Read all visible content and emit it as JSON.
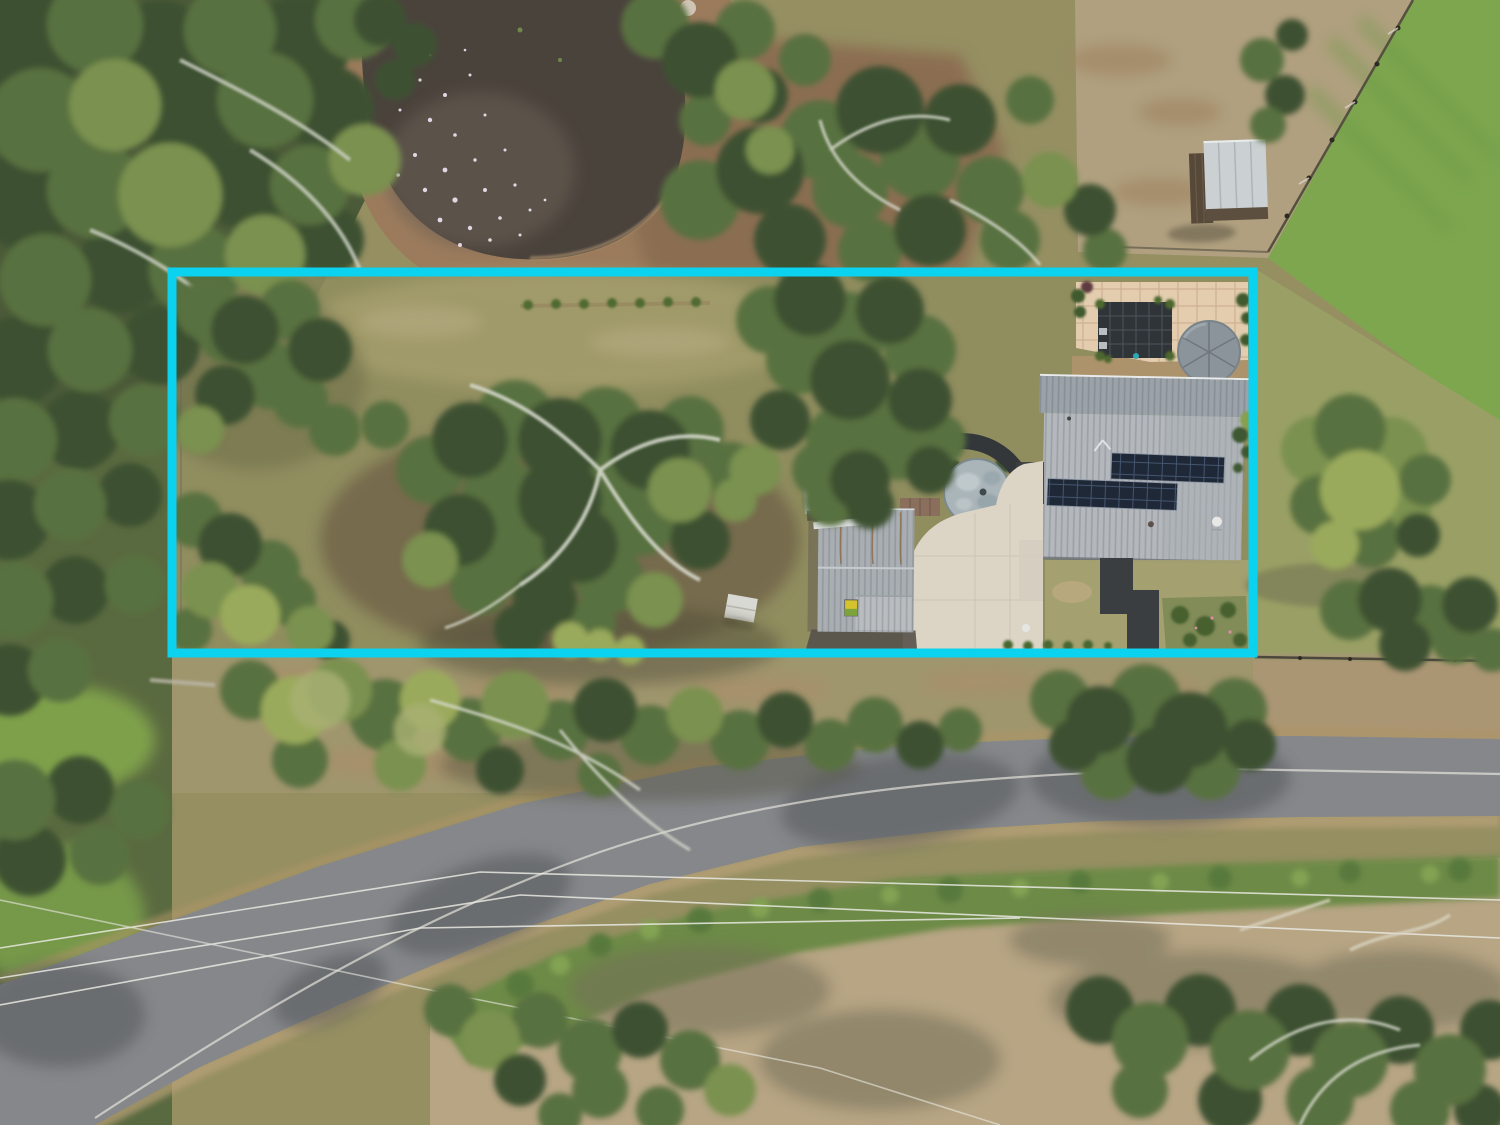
{
  "scene": {
    "kind": "aerial-drone-photograph",
    "description": "Top-down drone photo of a semi-rural residential acreage lot outlined with a cyan property-boundary overlay. Inside the boundary: treed paddock on the left, house with grey corrugated roof and two rows of solar panels on the right, paved patio with dark pergola and round water tank, older round tank, detached garage with wheelie bin, large concrete driveway, lawn with dark paved paths and garden beds. Outside: dam/pond at top, small shed and bright green fenced paddock top right, bitumen road with white centre line curving across the bottom, power lines, dry grass verges and dense gum trees.",
    "overlay": {
      "label": "property-boundary-highlight",
      "shape": "rectangle",
      "x": 172,
      "y": 272,
      "width": 1081,
      "height": 381,
      "stroke_px": 9
    },
    "features": [
      "dam-pond-with-sun-sparkle",
      "dirt-bank",
      "gum-tree-forest-top-left",
      "small-shed-top-right",
      "diagonal-paddock-fence",
      "bright-green-paddock",
      "house-grey-corrugated-roof",
      "solar-panel-array-row-1",
      "solar-panel-array-row-2",
      "veranda-roof",
      "paved-patio",
      "dark-pergola-spa-cover",
      "round-water-tank-new",
      "round-water-tank-old",
      "detached-garage",
      "yellow-lid-wheelie-bin",
      "concrete-driveway",
      "charcoal-garden-paths",
      "garden-beds",
      "shrub-row",
      "small-cabin-in-trees",
      "white-marquee",
      "bitumen-road",
      "road-centre-line",
      "power-lines",
      "grass-verges",
      "tree-shadows"
    ],
    "colors": {
      "boundary_cyan": "#0BD2EF",
      "pond_water": "#4A433C",
      "grass_olive": "#958F62",
      "grass_dry": "#B7A584",
      "paddock_green": "#7DA64F",
      "road_asphalt": "#85878A",
      "concrete_driveway": "#DCD5C5",
      "house_roof": "#B4B8BC",
      "veranda_roof": "#9BA2A8",
      "solar_panel": "#1E2836",
      "patio_pavers": "#E3CDAE",
      "pergola_dark": "#2F3438",
      "tank_gray": "#8B949B",
      "old_tank_top": "#AAB5B9",
      "garage_roof": "#A9AEB2",
      "shed_roof": "#CBD0D2",
      "path_charcoal": "#3A3E41",
      "bin_lid_yellow": "#D4C32C"
    }
  }
}
